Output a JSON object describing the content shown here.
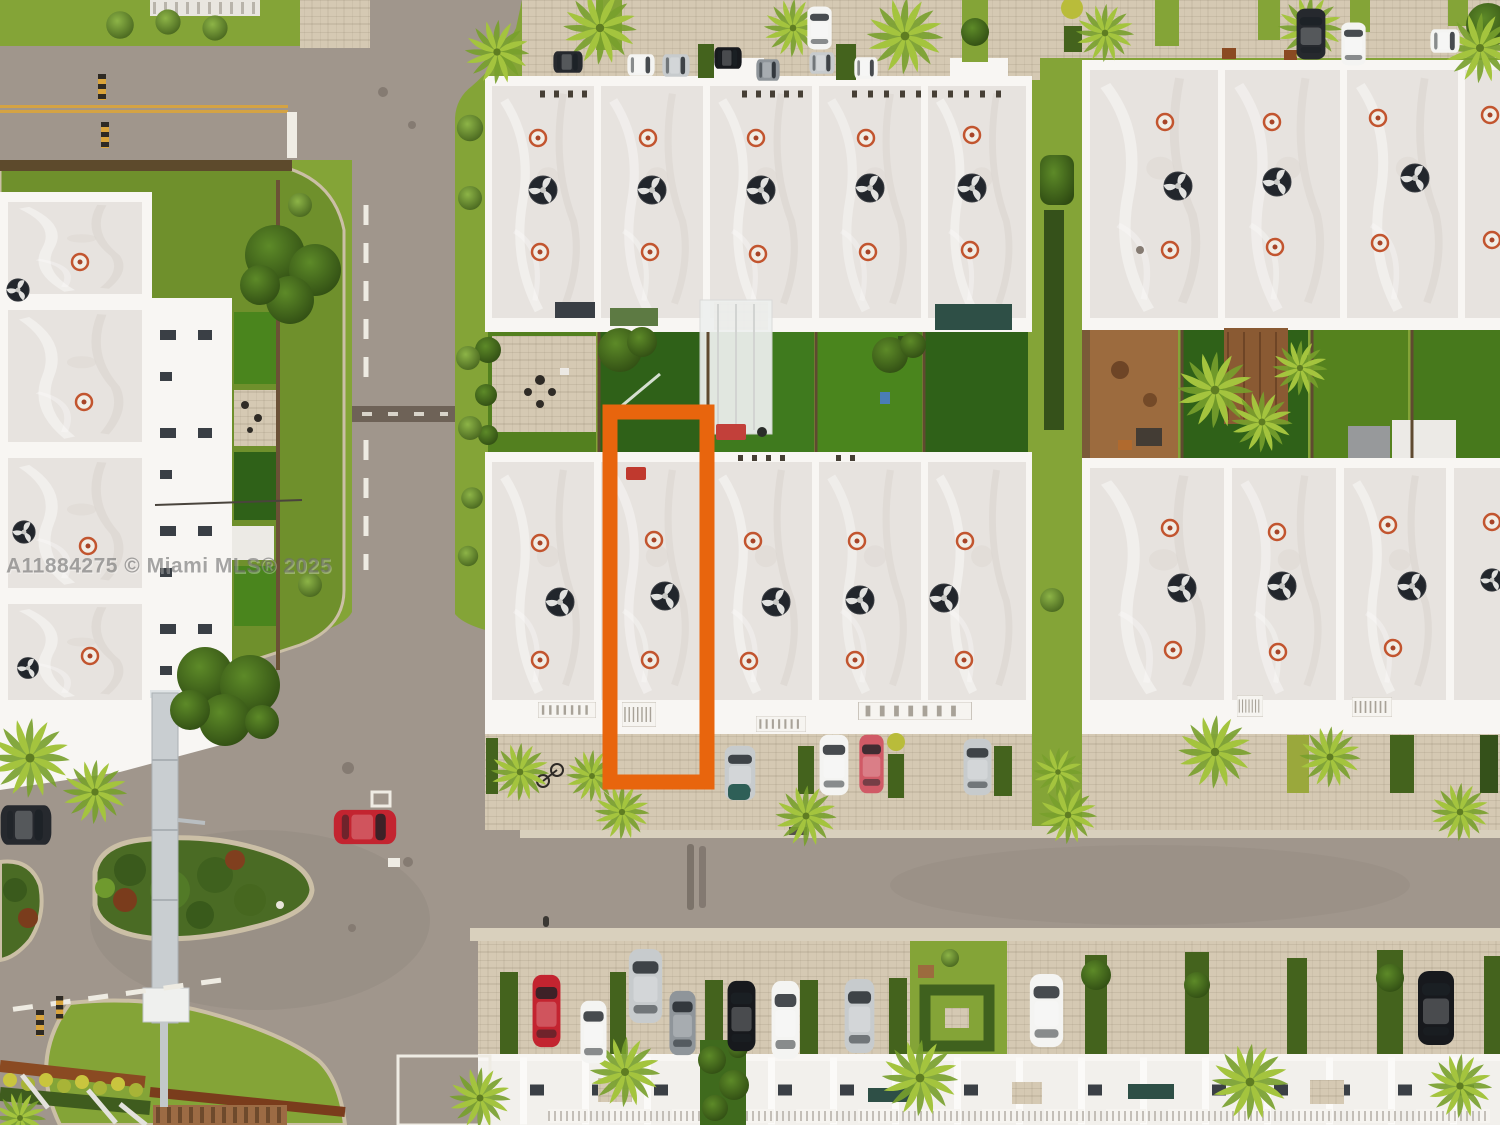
{
  "watermark": {
    "text": "A11884275 © Miami MLS® 2025"
  },
  "annotation": {
    "label": "highlighted-townhouse-unit",
    "shape": "rectangle-outline",
    "color": "#e8650d"
  },
  "scene": {
    "type": "aerial-drone-photo",
    "subject": "White flat-roof townhouse community with landscaped streets; one middle unit outlined in orange",
    "features": [
      "townhouse roof blocks with AC fans and vents",
      "backyards with turf and patios",
      "paver parking strips with cars and hedges",
      "curved entrance road with gate pylon",
      "teardrop landscape island",
      "palm trees",
      "main road",
      "bottom row of facades"
    ],
    "cars": {
      "top_strip": [
        "dark",
        "white",
        "silver",
        "black",
        "gray",
        "white-suv",
        "silver",
        "white-van",
        "dark-suv",
        "white",
        "white"
      ],
      "middle_strip": [
        "silver",
        "white-suv",
        "pink",
        "silver"
      ],
      "bottom_strip": [
        "red",
        "white",
        "silver-suv",
        "gray",
        "black",
        "white-suv",
        "silver",
        "white",
        "black"
      ],
      "on_road": [
        "red"
      ],
      "plaza_edge": [
        "dark"
      ]
    }
  },
  "palette": {
    "grass": "#84a437",
    "grass-dark": "#6f902c",
    "turf": "#2f6118",
    "turf-bright": "#4a851d",
    "hedge": "#44631d",
    "hedge-dark": "#35511a",
    "palm": "#a4c43e",
    "palm-dark": "#78a02c",
    "asphalt": "#a0968c",
    "paver": "#d5c9b3",
    "concrete": "#d9d0bd",
    "curb": "#cbbfa6",
    "roof": "#e7e3df",
    "parapet": "#f8f6f3",
    "facade": "#f2f0ec",
    "orange": "#e8650d",
    "mulch": "#8a4a22",
    "soil": "#9c6b3e",
    "wood": "#8a5a33",
    "watermark": "#6e6e6e",
    "yellow-line": "#d9a43c",
    "car-red": "#c32430",
    "car-pink": "#d05a66",
    "car-white": "#f4f4f2",
    "car-silver": "#c7cbcd",
    "car-gray": "#8f959a",
    "car-dark": "#26292e",
    "car-black": "#17191d",
    "car-teal": "#2e5f57"
  }
}
